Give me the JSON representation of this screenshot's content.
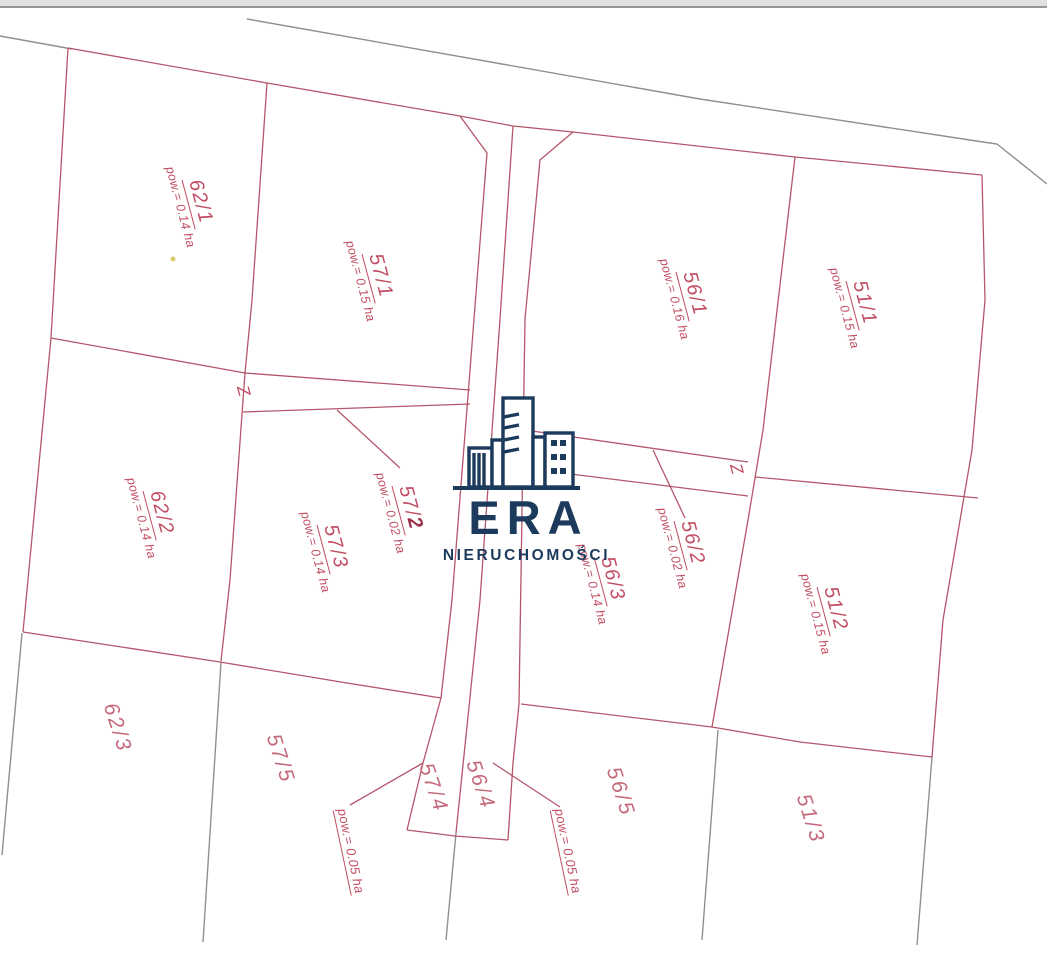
{
  "branding": {
    "logo_text": "ERA",
    "logo_subtitle": "NIERUCHOMOŚCI"
  },
  "colors": {
    "parcel_line": "#b5566b",
    "parcel_text": "#c24d63",
    "parcel_text_light": "#c4687a",
    "bold_digit": "#9c3049",
    "legacy_line": "#8f8f8f",
    "logo_navy": "#1b3a5c",
    "scan_band": "#e0e0e0",
    "scan_edge": "#979797",
    "speck_yellow": "#d8cf6e"
  },
  "parcels": [
    {
      "id": "62-1",
      "label": "62/1",
      "label_bold": "",
      "area": "pow.= 0.14 ha",
      "x": 192,
      "y": 204,
      "rot": 75,
      "style": "full"
    },
    {
      "id": "57-1",
      "label": "57/1",
      "label_bold": "",
      "area": "pow.= 0.15 ha",
      "x": 372,
      "y": 278,
      "rot": 75,
      "style": "full"
    },
    {
      "id": "56-1",
      "label": "56/1",
      "label_bold": "",
      "area": "pow.= 0.16 ha",
      "x": 686,
      "y": 296,
      "rot": 75,
      "style": "full"
    },
    {
      "id": "51-1",
      "label": "51/1",
      "label_bold": "",
      "area": "pow.= 0.15 ha",
      "x": 856,
      "y": 305,
      "rot": 75,
      "style": "full"
    },
    {
      "id": "62-2",
      "label": "62/2",
      "label_bold": "",
      "area": "pow.= 0.14 ha",
      "x": 153,
      "y": 515,
      "rot": 75,
      "style": "full"
    },
    {
      "id": "57-2",
      "label": "57/",
      "label_bold": "2",
      "area": "pow.= 0.02 ha",
      "x": 402,
      "y": 510,
      "rot": 75,
      "style": "full"
    },
    {
      "id": "57-3",
      "label": "57/3",
      "label_bold": "",
      "area": "pow.= 0.14 ha",
      "x": 327,
      "y": 549,
      "rot": 75,
      "style": "full"
    },
    {
      "id": "56-2",
      "label": "56/2",
      "label_bold": "",
      "area": "pow.= 0.02 ha",
      "x": 684,
      "y": 545,
      "rot": 75,
      "style": "full"
    },
    {
      "id": "56-3",
      "label": "56/3",
      "label_bold": "",
      "area": "pow.= 0.14 ha",
      "x": 604,
      "y": 581,
      "rot": 75,
      "style": "full"
    },
    {
      "id": "51-2",
      "label": "51/2",
      "label_bold": "",
      "area": "pow.= 0.15 ha",
      "x": 827,
      "y": 611,
      "rot": 75,
      "style": "full"
    },
    {
      "id": "62-3",
      "label": "62/3",
      "label_bold": "",
      "area": "",
      "x": 117,
      "y": 728,
      "rot": 72,
      "style": "simple"
    },
    {
      "id": "57-5",
      "label": "57/5",
      "label_bold": "",
      "area": "",
      "x": 280,
      "y": 759,
      "rot": 72,
      "style": "simple"
    },
    {
      "id": "57-4",
      "label": "57/4",
      "label_bold": "",
      "area": "",
      "x": 433,
      "y": 788,
      "rot": 71,
      "style": "simple"
    },
    {
      "id": "56-4",
      "label": "56/4",
      "label_bold": "",
      "area": "",
      "x": 480,
      "y": 785,
      "rot": 71,
      "style": "simple"
    },
    {
      "id": "56-5",
      "label": "56/5",
      "label_bold": "",
      "area": "",
      "x": 620,
      "y": 792,
      "rot": 72,
      "style": "simple"
    },
    {
      "id": "51-3",
      "label": "51/3",
      "label_bold": "",
      "area": "",
      "x": 810,
      "y": 819,
      "rot": 72,
      "style": "simple"
    }
  ],
  "area_labels": [
    {
      "id": "pow-57-4",
      "text": "pow.= 0.05 ha",
      "x": 351,
      "y": 851,
      "rot": 78
    },
    {
      "id": "pow-56-4",
      "text": "pow.= 0.05 ha",
      "x": 568,
      "y": 851,
      "rot": 78
    }
  ],
  "survey_marks": [
    {
      "id": "z-west",
      "text": "Z",
      "x": 243,
      "y": 391,
      "rot": 75
    },
    {
      "id": "z-east",
      "text": "Z",
      "x": 736,
      "y": 469,
      "rot": 75
    }
  ],
  "geometry": {
    "red_lines": [
      [
        [
          68,
          48
        ],
        [
          267,
          83
        ],
        [
          460,
          116
        ],
        [
          513,
          126
        ],
        [
          573,
          132
        ],
        [
          795,
          157
        ],
        [
          982,
          175
        ]
      ],
      [
        [
          68,
          48
        ],
        [
          51,
          338
        ],
        [
          23,
          632
        ]
      ],
      [
        [
          51,
          338
        ],
        [
          245,
          373
        ]
      ],
      [
        [
          267,
          83
        ],
        [
          252,
          300
        ],
        [
          245,
          373
        ],
        [
          230,
          580
        ],
        [
          221,
          661
        ]
      ],
      [
        [
          23,
          632
        ],
        [
          220,
          662
        ],
        [
          347,
          683
        ],
        [
          441,
          698
        ]
      ],
      [
        [
          521,
          704
        ],
        [
          712,
          727
        ],
        [
          800,
          742
        ],
        [
          932,
          757
        ]
      ],
      [
        [
          982,
          175
        ],
        [
          985,
          300
        ],
        [
          972,
          450
        ],
        [
          943,
          620
        ],
        [
          932,
          757
        ]
      ],
      [
        [
          755,
          477
        ],
        [
          978,
          498
        ]
      ],
      [
        [
          795,
          157
        ],
        [
          763,
          430
        ],
        [
          748,
          520
        ],
        [
          712,
          727
        ]
      ],
      [
        [
          460,
          116
        ],
        [
          487,
          153
        ],
        [
          474,
          319
        ],
        [
          452,
          600
        ],
        [
          441,
          698
        ],
        [
          423,
          763
        ],
        [
          407,
          830
        ]
      ],
      [
        [
          513,
          126
        ],
        [
          500,
          319
        ],
        [
          480,
          600
        ],
        [
          456,
          833
        ]
      ],
      [
        [
          573,
          132
        ],
        [
          540,
          160
        ],
        [
          525,
          319
        ],
        [
          519,
          704
        ],
        [
          513,
          763
        ],
        [
          508,
          840
        ]
      ],
      [
        [
          407,
          830
        ],
        [
          455,
          836
        ],
        [
          508,
          840
        ]
      ],
      [
        [
          245,
          373
        ],
        [
          470,
          390
        ]
      ],
      [
        [
          243,
          412
        ],
        [
          470,
          404
        ]
      ],
      [
        [
          525,
          430
        ],
        [
          748,
          462
        ]
      ],
      [
        [
          522,
          468
        ],
        [
          748,
          496
        ]
      ],
      [
        [
          337,
          410
        ],
        [
          400,
          468
        ]
      ],
      [
        [
          653,
          450
        ],
        [
          685,
          518
        ]
      ],
      [
        [
          350,
          805
        ],
        [
          423,
          763
        ]
      ],
      [
        [
          493,
          763
        ],
        [
          560,
          807
        ]
      ]
    ],
    "gray_lines": [
      [
        [
          0,
          36
        ],
        [
          72,
          49
        ]
      ],
      [
        [
          247,
          19
        ],
        [
          700,
          99
        ],
        [
          983,
          142
        ],
        [
          997,
          144
        ],
        [
          1047,
          184
        ]
      ],
      [
        [
          22,
          633
        ],
        [
          2,
          855
        ]
      ],
      [
        [
          221,
          662
        ],
        [
          203,
          942
        ]
      ],
      [
        [
          456,
          833
        ],
        [
          446,
          940
        ]
      ],
      [
        [
          718,
          730
        ],
        [
          702,
          940
        ]
      ],
      [
        [
          932,
          757
        ],
        [
          917,
          945
        ]
      ]
    ],
    "specks": [
      {
        "x": 173,
        "y": 259,
        "r": 2.5
      }
    ]
  }
}
